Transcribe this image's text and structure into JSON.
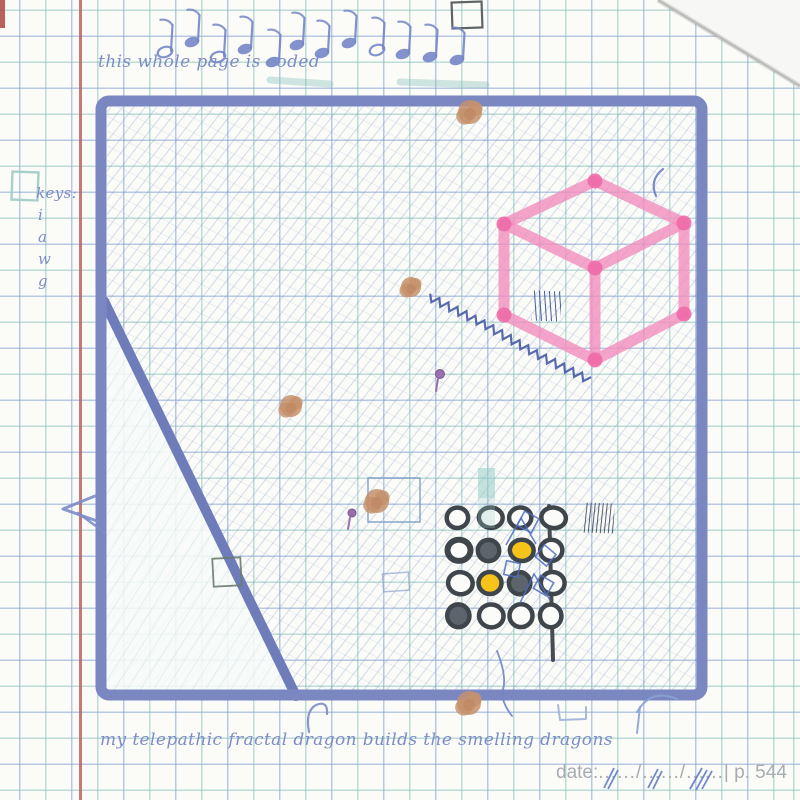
{
  "page": {
    "top_caption": "this whole page is coded",
    "bottom_caption": "my telepathic fractal dragon builds the smelling dragons",
    "keys": {
      "label": "keys:",
      "items": [
        "i",
        "a",
        "w",
        "g"
      ]
    },
    "footer": {
      "date_label": "date:",
      "date_dots": "....../....../......",
      "separator": "|",
      "page_number": "p. 544"
    }
  },
  "colors": {
    "ink_blue": "#7585c6",
    "hand_blue": "#7d8dc6",
    "border_blue": "#7b87c1",
    "diagonal_blue": "#6f7cba",
    "pink": "#f48fbe",
    "pink_dot": "#ee6ca9",
    "yellow": "#f5c31a",
    "dark_fill": "#5d646b",
    "ring_dark": "#3e454b",
    "tan_splotch": "#c6916c",
    "purple_pin": "#9a6fae",
    "red_margin": "#ba5450",
    "teal_grid": "#80bcb5",
    "zigzag_blue": "#4a5ca6",
    "doodle_blue": "#4f6cc0",
    "footer_gray": "#a8acb2",
    "pen_scribble": "#5a74c4"
  },
  "token_grid": {
    "state_legend": [
      "open",
      "open_thick",
      "dark",
      "yellow"
    ],
    "rows": [
      [
        "open",
        "open",
        "open",
        "open"
      ],
      [
        "open_thick",
        "dark",
        "yellow",
        "open"
      ],
      [
        "open",
        "yellow",
        "dark",
        "open"
      ],
      [
        "dark",
        "open",
        "open",
        "open"
      ]
    ]
  },
  "music_notes": {
    "styles": [
      "open",
      "filled",
      "open",
      "filled",
      "filled",
      "filled",
      "filled",
      "filled",
      "open",
      "filled",
      "filled",
      "filled"
    ]
  }
}
